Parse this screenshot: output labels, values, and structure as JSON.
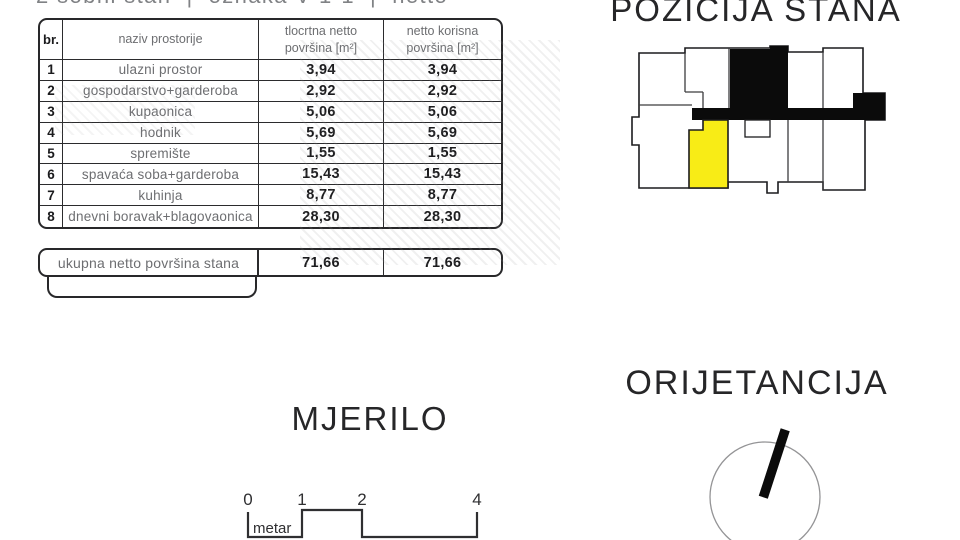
{
  "caption": {
    "text": "2 sobni stan  |  oznaka V-1-1  |  netto"
  },
  "table": {
    "header": {
      "num": "br.",
      "name": "naziv prostorije",
      "col1_line1": "tlocrtna netto",
      "col1_line2": "površina [m²]",
      "col2_line1": "netto korisna",
      "col2_line2": "površina [m²]"
    },
    "rows": [
      {
        "num": "1",
        "name": "ulazni prostor",
        "a1": "3,94",
        "a2": "3,94"
      },
      {
        "num": "2",
        "name": "gospodarstvo+garderoba",
        "a1": "2,92",
        "a2": "2,92"
      },
      {
        "num": "3",
        "name": "kupaonica",
        "a1": "5,06",
        "a2": "5,06"
      },
      {
        "num": "4",
        "name": "hodnik",
        "a1": "5,69",
        "a2": "5,69"
      },
      {
        "num": "5",
        "name": "spremište",
        "a1": "1,55",
        "a2": "1,55"
      },
      {
        "num": "6",
        "name": "spavaća soba+garderoba",
        "a1": "15,43",
        "a2": "15,43"
      },
      {
        "num": "7",
        "name": "kuhinja",
        "a1": "8,77",
        "a2": "8,77"
      },
      {
        "num": "8",
        "name": "dnevni boravak+blagovaonica",
        "a1": "28,30",
        "a2": "28,30"
      }
    ],
    "total": {
      "label": "ukupna netto površina stana",
      "a1": "71,66",
      "a2": "71,66"
    }
  },
  "position_section": {
    "title": "POZICIJA STANA"
  },
  "scale_section": {
    "title": "MJERILO",
    "tick0": "0",
    "tick1": "1",
    "tick2": "2",
    "tick4": "4",
    "unit_label": "metar"
  },
  "orientation_section": {
    "title": "ORIJETANCIJA"
  },
  "colors": {
    "highlight_unit": "#f8ec16",
    "black_fill": "#0b0b0b",
    "outline": "#1c1c1e",
    "text_gray": "#6d6e71",
    "text_dark": "#1b1b1d"
  }
}
